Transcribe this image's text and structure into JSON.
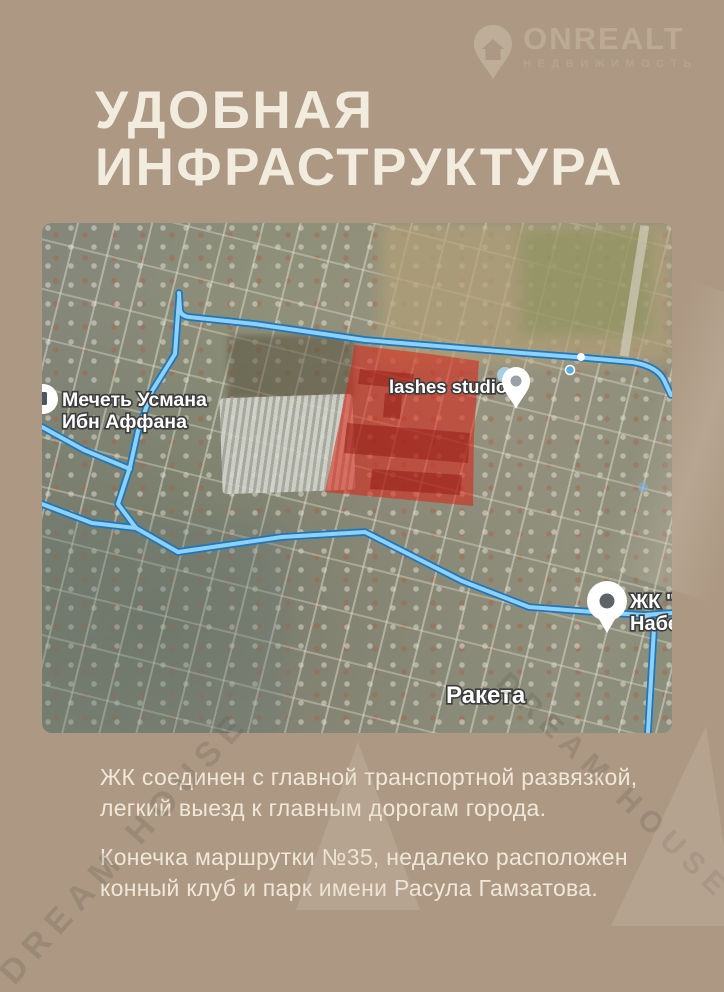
{
  "brand": {
    "name": "ONREALT",
    "tagline": "НЕДВИЖИМОСТЬ",
    "logo_icon": "location-pin-house-icon"
  },
  "title": {
    "line1": "УДОБНАЯ",
    "line2": "ИНФРАСТРУКТУРА"
  },
  "map": {
    "type": "satellite-map-with-route-overlay",
    "labels": {
      "mosque_line1": "Мечеть Усмана",
      "mosque_line2": "Ибн Аффана",
      "lashes": "lashes studio",
      "zhk_line1": "ЖК \"Д",
      "zhk_line2": "Набер",
      "raketa": "Ракета"
    },
    "icons": [
      "mosque-pin-icon",
      "lashes-pin-icon",
      "zhk-pin-icon",
      "route-via-dot"
    ],
    "highlight": "red-plot-polygon"
  },
  "body_text": {
    "p1_line1": "ЖК соединен с главной транспортной развязкой,",
    "p1_line2": "легкий выезд к главным дорогам города.",
    "p2_line1": "Конечка маршрутки №35, недалеко расположен",
    "p2_line2": "конный клуб и парк имени Расула Гамзатова."
  },
  "watermark": {
    "text": "DREAM HOUSE"
  },
  "colors": {
    "background": "#ac9883",
    "title_text": "#f2ecdf",
    "body_text": "#efe8d9",
    "logo_text": "#bcab94",
    "route_outer": "#1d77bc",
    "route_inner": "#8fd1f6",
    "red_zone": "#dc1f12",
    "map_label_text": "#ffffff",
    "map_label_outline": "#3c3c3c"
  }
}
